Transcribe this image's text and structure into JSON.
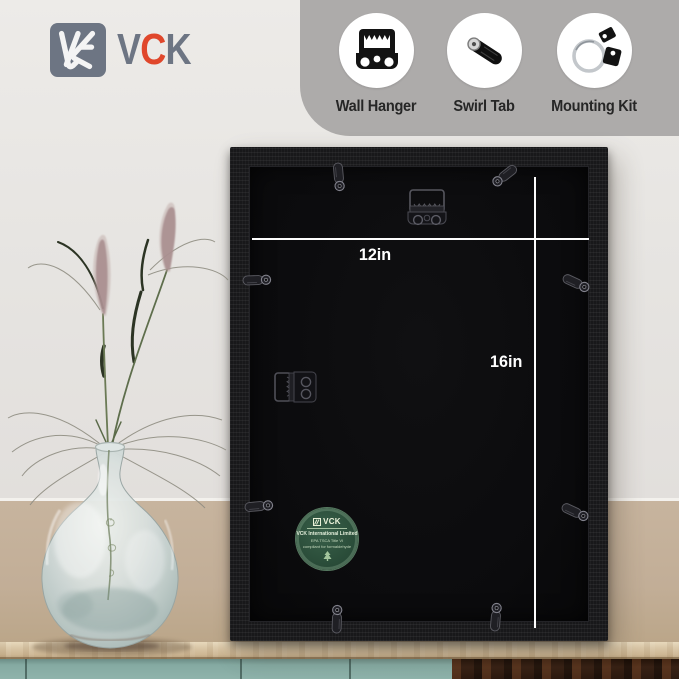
{
  "brand": {
    "name": "VCK",
    "letter_v": "V",
    "letter_c": "C",
    "letter_k": "K"
  },
  "features": {
    "items": [
      {
        "label": "Wall Hanger",
        "icon": "wall-hanger-icon"
      },
      {
        "label": "Swirl Tab",
        "icon": "swirl-tab-icon"
      },
      {
        "label": "Mounting Kit",
        "icon": "mounting-kit-icon"
      }
    ]
  },
  "frame": {
    "width_label": "12in",
    "height_label": "16in"
  },
  "sticker": {
    "brand": "VCK",
    "company": "VCK International Limited",
    "compliance_line1": "EPA TSCA Title VI",
    "compliance_line2": "compliant for formaldehyde"
  },
  "colors": {
    "accent_red": "#e0472b",
    "logo_gray": "#6d7583",
    "banner_gray": "#adabaa",
    "wall_upper": "#e6e4e1",
    "wall_lower": "#c2ae97",
    "frame_black": "#18181a",
    "backing_black": "#0b0b0d",
    "dimension_line": "#ffffff",
    "sticker_green": "#2c4f3b",
    "cabinet_teal": "#8fb3ab",
    "tabletop_wood": "#d6c3a4"
  }
}
